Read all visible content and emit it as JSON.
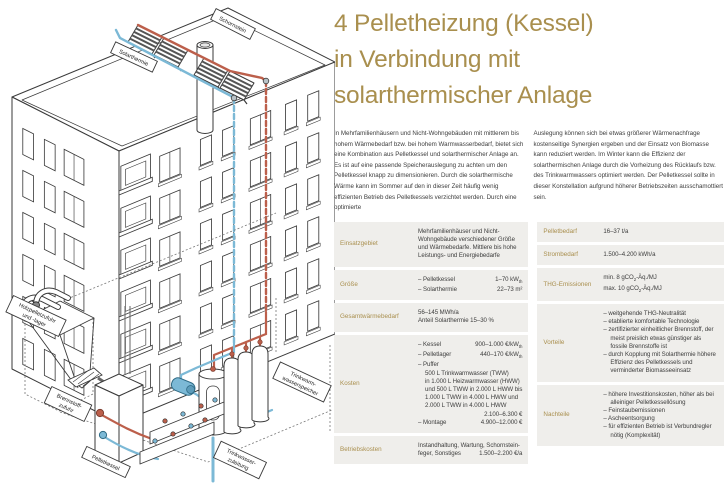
{
  "title_lines": [
    "4 Pelletheizung (Kessel)",
    "in Verbindung mit",
    "solarthermischer Anlage"
  ],
  "intro": {
    "col1": "In Mehrfamilienhäusern und Nicht-Wohngebäuden mit mittlerem bis hohem Wärmebedarf bzw. bei hohem Warmwasserbedarf, bietet sich eine Kombination aus Pelletkessel und solarthermischer Anlage an. Es ist auf eine passende Speicherauslegung zu achten um den Pelletkessel knapp zu dimensionieren. Durch die solarthermische Wärme kann im Sommer auf den in dieser Zeit häufig wenig effizienten Betrieb des Pelletkessels verzichtet werden. Durch eine optimierte",
    "col2": "Auslegung können sich bei etwas größerer Wärmenachfrage kostenseitige Synergien ergeben und der Einsatz von Biomasse kann reduziert werden. Im Winter kann die Effizienz der solarthermischen Anlage durch die Vorheizung des Rücklaufs bzw. des Trinkwarmwassers optimiert werden. Der Pelletkessel sollte in dieser Konstellation aufgrund höherer Betriebszeiten ausschamottiert sein."
  },
  "spec_left": [
    {
      "key": "einsatzgebiet",
      "label": "Einsatzgebiet",
      "lines": [
        {
          "text": "Mehrfamilienhäuser und Nicht-Wohngebäude verschiedener Größe und Wärmebedarfe. Mittlere bis hohe Leistungs- und Energiebedarfe",
          "wrap": true
        }
      ]
    },
    {
      "key": "groesse",
      "label": "Größe",
      "lines": [
        {
          "text": "– Pelletkessel",
          "value": "1–70 kW[th]"
        },
        {
          "text": "– Solarthermie",
          "value": "22–73 m²"
        }
      ]
    },
    {
      "key": "gesamtwaermebedarf",
      "label": "Gesamtwärmebedarf",
      "lines": [
        {
          "text": "56–145 MWh/a"
        },
        {
          "text": "Anteil Solarthermie 15–30 %"
        }
      ]
    },
    {
      "key": "kosten",
      "label": "Kosten",
      "lines": [
        {
          "text": "– Kessel",
          "value": "900–1.000 €/kW[th]"
        },
        {
          "text": "– Pelletlager",
          "value": "440–170 €/kW[th]"
        },
        {
          "text": "– Puffer"
        },
        {
          "text": "500 L Trinkwarmwasser (TWW)",
          "indent": true
        },
        {
          "text": "in 1.000 L Heizwarmwasser (HWW)",
          "indent": true
        },
        {
          "text": "und 500 L TWW in 2.000 L HWW bis",
          "indent": true
        },
        {
          "text": "1.000 L TWW in 4.000 L HWW und",
          "indent": true
        },
        {
          "text": "2.000 L TWW in 4.000 L HWW",
          "indent": true
        },
        {
          "text": "",
          "value": "2.100–6.300 €"
        },
        {
          "text": "– Montage",
          "value": "4.900–12.000 €"
        }
      ]
    },
    {
      "key": "betriebskosten",
      "label": "Betriebskosten",
      "lines": [
        {
          "text": "Instandhaltung, Wartung, Schornstein-"
        },
        {
          "text": "feger, Sonstiges",
          "value": "1.500–2.200 €/a"
        }
      ]
    }
  ],
  "spec_right": [
    {
      "key": "pelletbedarf",
      "label": "Pelletbedarf",
      "lines": [
        {
          "text": "16–37 t/a"
        }
      ]
    },
    {
      "key": "strombedarf",
      "label": "Strombedarf",
      "lines": [
        {
          "text": "1.500–4.200 kWh/a"
        }
      ]
    },
    {
      "key": "thg-emissionen",
      "label": "THG-Emissionen",
      "lines": [
        {
          "text": "min. 8 gCO[2]-Äq./MJ"
        },
        {
          "text": "max. 10 gCO[2]-Äq./MJ"
        }
      ]
    },
    {
      "key": "vorteile",
      "label": "Vorteile",
      "lines": [
        {
          "text": "weitgehende THG-Neutralität",
          "bullet": true
        },
        {
          "text": "etablierte komfortable Technologie",
          "bullet": true
        },
        {
          "text": "zertifizierter einheitlicher Brennstoff, der meist preislich etwas günstiger als fossile Brennstoffe ist",
          "bullet": true
        },
        {
          "text": "durch Kopplung mit Solarthermie höhere Effizienz des Pelletkessels und verminderter Biomasseeinsatz",
          "bullet": true
        }
      ]
    },
    {
      "key": "nachteile",
      "label": "Nachteile",
      "lines": [
        {
          "text": "höhere Investitionskosten, höher als bei alleiniger Pelletkessellösung",
          "bullet": true
        },
        {
          "text": "Feinstaubemissionen",
          "bullet": true
        },
        {
          "text": "Ascheentsorgung",
          "bullet": true
        },
        {
          "text": "für effizienten Betrieb ist Verbundregler nötig (Komplexität)",
          "bullet": true
        }
      ]
    }
  ],
  "diagram": {
    "labels": {
      "schornstein": "Schornstein",
      "solarthermie": "Solarthermie",
      "holzpellet_line1": "Holzpelletzufuhr",
      "holzpellet_line2": "und -lager",
      "brennstoff_line1": "Brennstoff-",
      "brennstoff_line2": "zufuhr",
      "pelletkessel": "Pelletkessel",
      "tww_line1": "Trinkwarm-",
      "tww_line2": "wasserspeicher",
      "twz_line1": "Trinkwasser-",
      "twz_line2": "zuleitung"
    }
  },
  "colors": {
    "accent_gold": "#a98f4e",
    "row_background": "#efeeeb",
    "pipe_red": "#bc5f4b",
    "pipe_blue": "#7cb9d6",
    "line": "#3a3a3a"
  }
}
